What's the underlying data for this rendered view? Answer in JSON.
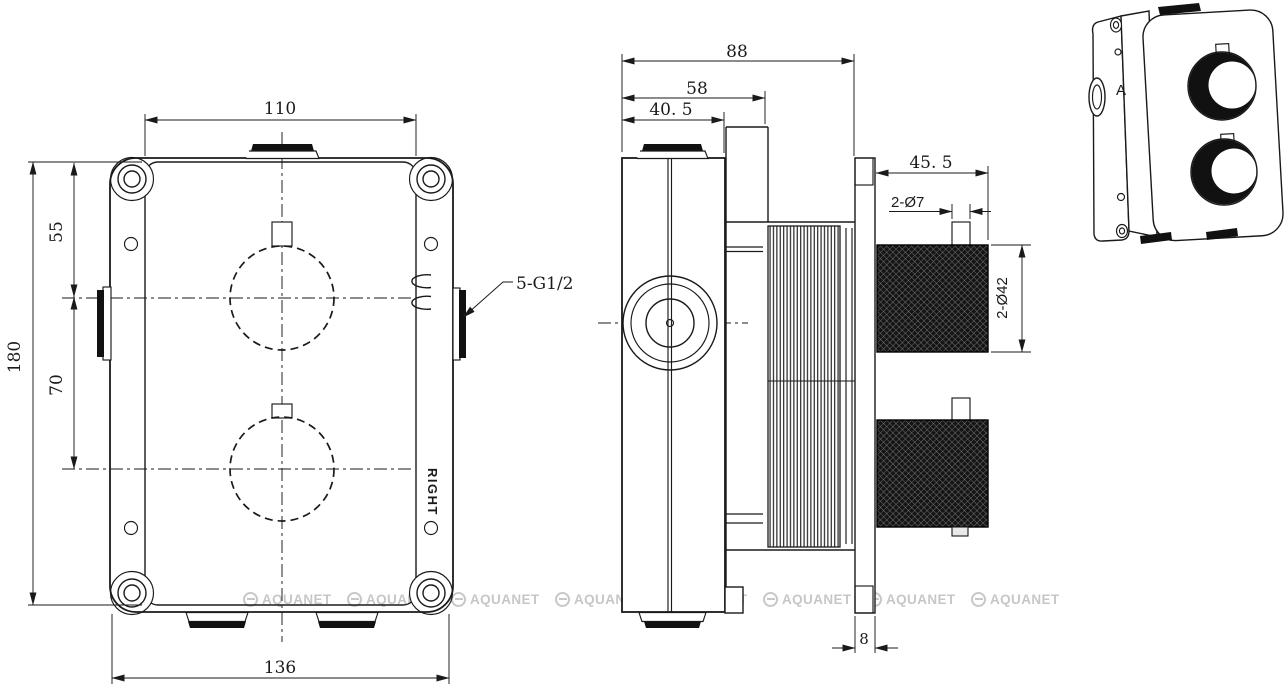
{
  "page": {
    "type": "technical-drawing",
    "background": "#ffffff"
  },
  "watermark": {
    "text": "AQUANET",
    "count": 8,
    "color": "#c7c7c7"
  },
  "front_view": {
    "dims": {
      "plate_width": "110",
      "top_to_knob1": "55",
      "knob1_to_knob2": "70",
      "plate_height": "180",
      "box_width": "136"
    },
    "labels": {
      "ports": "5-G1/2",
      "orientation": "RIGHT"
    }
  },
  "side_view": {
    "dims": {
      "total_depth": "88",
      "cartridge_depth": "58",
      "body_depth": "40. 5",
      "handle_length": "45. 5",
      "stem_diameter": "2-Ø7",
      "handle_diameter": "2-Ø42",
      "plate_thickness": "8"
    }
  },
  "iso_view": {
    "label": "A"
  },
  "colors": {
    "line": "#1a1a1a",
    "dark_fill": "#111111",
    "watermark": "#c7c7c7",
    "background": "#ffffff"
  }
}
